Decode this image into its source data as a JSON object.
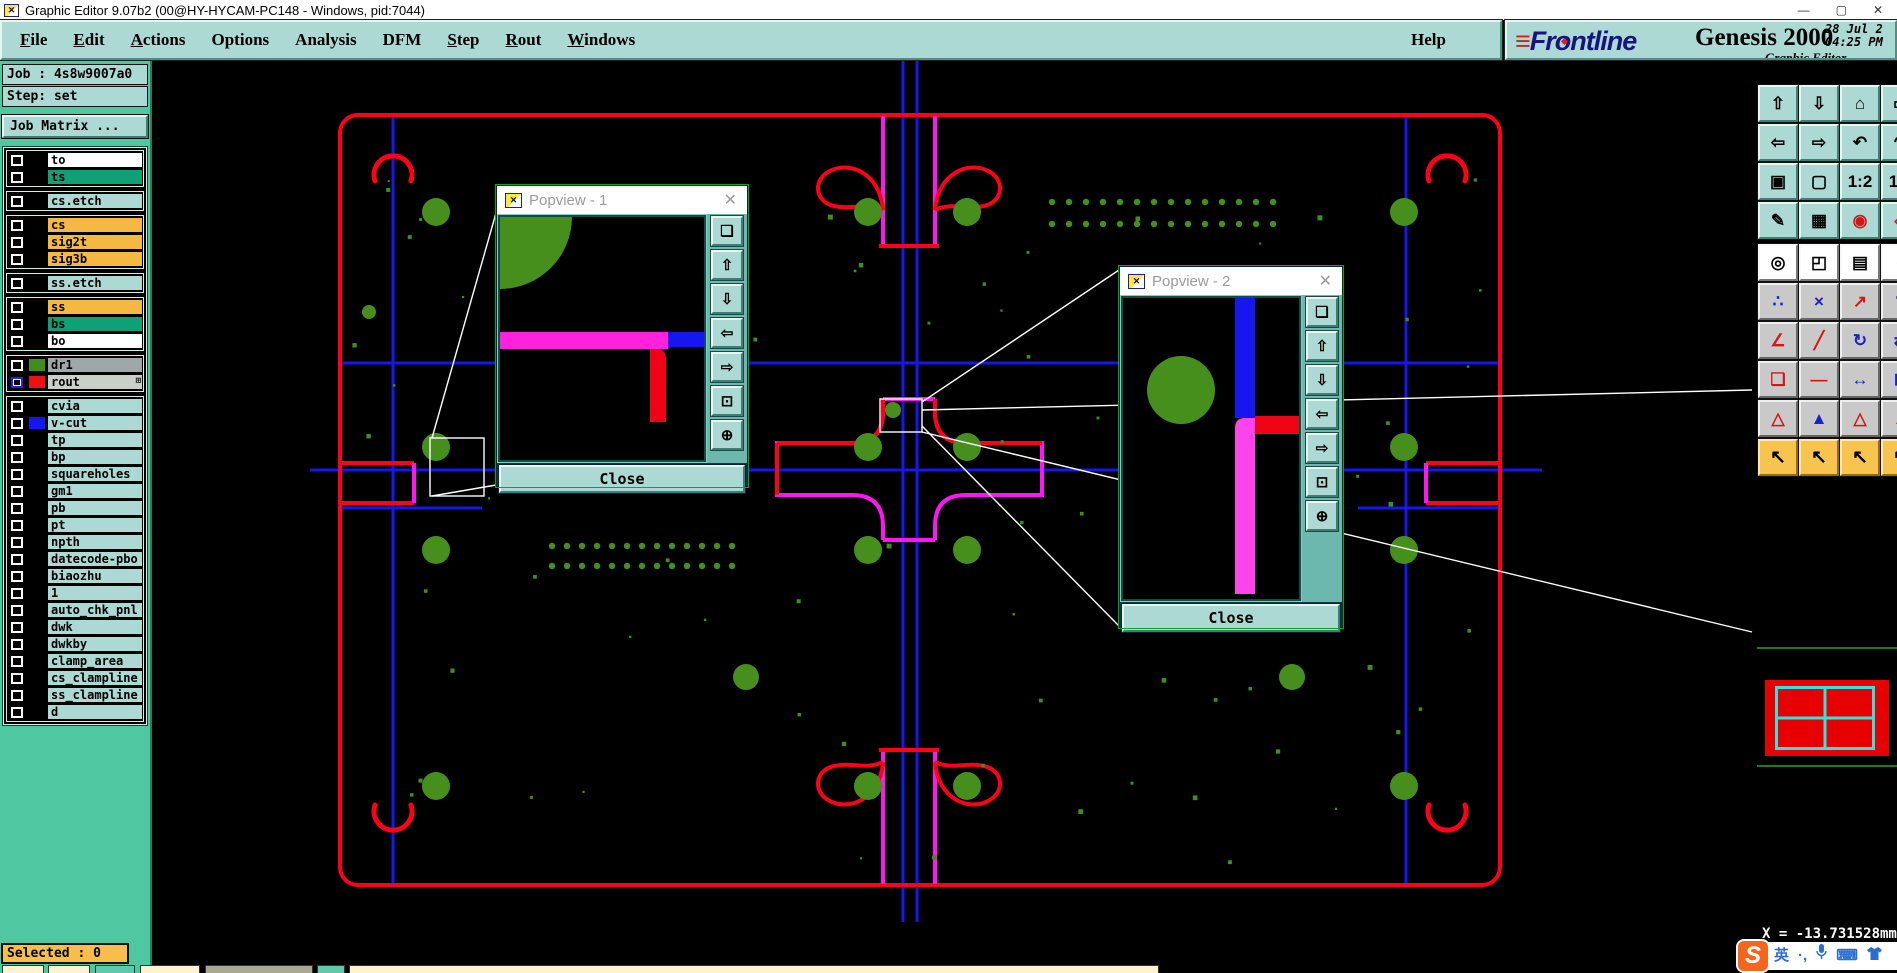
{
  "window": {
    "title": "Graphic Editor 9.07b2 (00@HY-HYCAM-PC148 - Windows, pid:7044)",
    "icon_glyph": "✕",
    "minimize": "—",
    "maximize": "▢",
    "close": "✕"
  },
  "menubar": {
    "items": [
      {
        "label": "File",
        "u": 0
      },
      {
        "label": "Edit",
        "u": 0
      },
      {
        "label": "Actions",
        "u": 0
      },
      {
        "label": "Options",
        "u": -1
      },
      {
        "label": "Analysis",
        "u": -1
      },
      {
        "label": "DFM",
        "u": -1
      },
      {
        "label": "Step",
        "u": 0
      },
      {
        "label": "Rout",
        "u": 0
      },
      {
        "label": "Windows",
        "u": 0
      }
    ],
    "help": {
      "label": "Help",
      "u": -1
    }
  },
  "brand": {
    "logo_speed": "≡",
    "logo_pre": "Fr",
    "logo_o": "o",
    "logo_post": "ntline",
    "product": "Genesis 2000",
    "subtitle": "Graphic Editor",
    "date": "28 Jul 2",
    "time": "04:25 PM"
  },
  "sidebar": {
    "job": "Job : 4s8w9007a0",
    "step": "Step: set",
    "matrix_button": "Job Matrix ...",
    "selected": "Selected : 0",
    "layer_groups": [
      [
        {
          "name": "to",
          "bg": "white"
        },
        {
          "name": "ts",
          "bg": "green"
        }
      ],
      [
        {
          "name": "cs.etch",
          "bg": "teal"
        }
      ],
      [
        {
          "name": "cs",
          "bg": "orange"
        },
        {
          "name": "sig2t",
          "bg": "orange"
        },
        {
          "name": "sig3b",
          "bg": "orange"
        }
      ],
      [
        {
          "name": "ss.etch",
          "bg": "teal"
        }
      ],
      [
        {
          "name": "ss",
          "bg": "orange"
        },
        {
          "name": "bs",
          "bg": "green"
        },
        {
          "name": "bo",
          "bg": "white"
        }
      ],
      [
        {
          "name": "dr1",
          "bg": "gray",
          "swatch": "#3e8e1e"
        },
        {
          "name": "rout",
          "bg": "lightgray",
          "swatch": "#ee1111",
          "cb": "blue",
          "badge": "⊞"
        }
      ],
      [
        {
          "name": "cvia",
          "bg": "teal"
        },
        {
          "name": "v-cut",
          "bg": "teal",
          "swatch": "#1616ee"
        },
        {
          "name": "tp",
          "bg": "teal"
        },
        {
          "name": "bp",
          "bg": "teal"
        },
        {
          "name": "squareholes",
          "bg": "teal"
        },
        {
          "name": "gm1",
          "bg": "teal"
        },
        {
          "name": "pb",
          "bg": "teal"
        },
        {
          "name": "pt",
          "bg": "teal"
        },
        {
          "name": "npth",
          "bg": "teal"
        },
        {
          "name": "datecode-pbo",
          "bg": "teal"
        },
        {
          "name": "biaozhu",
          "bg": "teal"
        },
        {
          "name": "1",
          "bg": "teal"
        },
        {
          "name": "auto_chk_pnl",
          "bg": "teal"
        },
        {
          "name": "dwk",
          "bg": "teal"
        },
        {
          "name": "dwkby",
          "bg": "teal"
        },
        {
          "name": "clamp_area",
          "bg": "teal"
        },
        {
          "name": "cs_clampline",
          "bg": "teal"
        },
        {
          "name": "ss_clampline",
          "bg": "teal"
        },
        {
          "name": "d",
          "bg": "teal"
        }
      ]
    ]
  },
  "toolbar": {
    "rows": [
      {
        "style": "teal",
        "buttons": [
          {
            "name": "pan-view-up",
            "glyph": "⇧"
          },
          {
            "name": "pan-view-down",
            "glyph": "⇩"
          },
          {
            "name": "home-view",
            "glyph": "⌂"
          },
          {
            "name": "window-view",
            "glyph": "▭"
          }
        ]
      },
      {
        "style": "teal",
        "buttons": [
          {
            "name": "pan-view-left",
            "glyph": "⇦"
          },
          {
            "name": "pan-view-right",
            "glyph": "⇨"
          },
          {
            "name": "previous-view",
            "glyph": "↶"
          },
          {
            "name": "next-view",
            "glyph": "↷"
          }
        ]
      },
      {
        "style": "teal",
        "buttons": [
          {
            "name": "zoom-out-fit",
            "glyph": "▣"
          },
          {
            "name": "zoom-in-center",
            "glyph": "▢"
          },
          {
            "name": "scale-1-2",
            "glyph": "1:2"
          },
          {
            "name": "scale-1-1",
            "glyph": "1:1"
          }
        ]
      },
      {
        "style": "teal",
        "buttons": [
          {
            "name": "setup-tools",
            "glyph": "✎"
          },
          {
            "name": "grid-toggle",
            "glyph": "▦"
          },
          {
            "name": "highlight-connection",
            "glyph": "◉",
            "red": true
          },
          {
            "name": "highlight-net",
            "glyph": "◈",
            "red": true
          }
        ]
      },
      {
        "style": "white",
        "buttons": [
          {
            "name": "select-feature",
            "glyph": "◎"
          },
          {
            "name": "zoom-area",
            "glyph": "◰"
          },
          {
            "name": "measure-ruler",
            "glyph": "▤"
          },
          {
            "name": "select-pad",
            "glyph": "◌"
          }
        ]
      },
      {
        "style": "gray",
        "buttons": [
          {
            "name": "show-net-nodes",
            "glyph": "∴"
          },
          {
            "name": "delete-feature",
            "glyph": "×"
          },
          {
            "name": "move-feature",
            "glyph": "↗",
            "red": true
          },
          {
            "name": "copy-dot",
            "glyph": "∵"
          }
        ]
      },
      {
        "style": "gray",
        "buttons": [
          {
            "name": "angle-tool",
            "glyph": "∠",
            "red": true
          },
          {
            "name": "slope-line",
            "glyph": "╱",
            "red": true
          },
          {
            "name": "rotate-feature",
            "glyph": "↻"
          },
          {
            "name": "mirror-feature",
            "glyph": "⇄"
          }
        ]
      },
      {
        "style": "gray",
        "buttons": [
          {
            "name": "duplicate-feature",
            "glyph": "❏",
            "red": true
          },
          {
            "name": "stretch-feature",
            "glyph": "—",
            "red": true
          },
          {
            "name": "spacing-measure",
            "glyph": "↔"
          },
          {
            "name": "snap-pad",
            "glyph": "⊡"
          }
        ]
      },
      {
        "style": "gray",
        "buttons": [
          {
            "name": "triangle-tool-1",
            "glyph": "△",
            "red": true
          },
          {
            "name": "triangle-tool-2",
            "glyph": "▲"
          },
          {
            "name": "triangle-tool-3",
            "glyph": "△",
            "red": true
          },
          {
            "name": "triangle-tool-4",
            "glyph": "▲",
            "red": true
          }
        ]
      },
      {
        "style": "yellow",
        "buttons": [
          {
            "name": "select-single",
            "glyph": "↖"
          },
          {
            "name": "select-frame",
            "glyph": "↖"
          },
          {
            "name": "select-polygon",
            "glyph": "↖"
          },
          {
            "name": "select-filter",
            "glyph": "↖"
          }
        ]
      }
    ]
  },
  "popviews": [
    {
      "title": "Popview - 1",
      "close": "Close",
      "icon_glyph": "✕",
      "x_glyph": "✕"
    },
    {
      "title": "Popview - 2",
      "close": "Close",
      "icon_glyph": "✕",
      "x_glyph": "✕"
    }
  ],
  "popview_buttons": [
    {
      "name": "popout-window",
      "glyph": "❏"
    },
    {
      "name": "pan-up",
      "glyph": "⇧"
    },
    {
      "name": "pan-down",
      "glyph": "⇩"
    },
    {
      "name": "pan-left",
      "glyph": "⇦"
    },
    {
      "name": "pan-right",
      "glyph": "⇨"
    },
    {
      "name": "zoom-fit",
      "glyph": "⊡"
    },
    {
      "name": "zoom-full",
      "glyph": "⊕"
    }
  ],
  "status": {
    "coords": "X = -13.731528mm"
  },
  "ime": {
    "logo": "S",
    "lang": "英",
    "punct": "·,",
    "keyboard": "⌨"
  },
  "colors": {
    "ui_teal": "#acd9d3",
    "sidebar_green": "#4fc8a2",
    "selected_orange": "#f8be4a",
    "board_red": "#ff0018",
    "board_blue": "#1616f0",
    "board_magenta": "#ff16f0",
    "board_green": "#478f1c",
    "layer_bg": {
      "white": "#ffffff",
      "green": "#0fa076",
      "teal": "#acd9d3",
      "orange": "#f4b942",
      "gray": "#9fa8a8",
      "lightgray": "#c9cfc9"
    }
  }
}
